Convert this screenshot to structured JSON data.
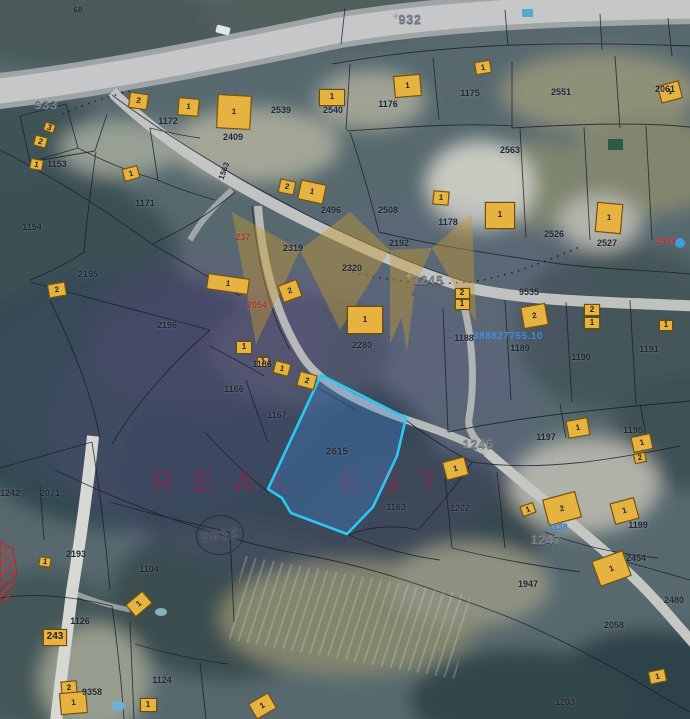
{
  "map": {
    "watermark": {
      "text": "REAL EST",
      "text_color": "rgba(150,33,68,0.40)",
      "logo_color": "#c99a2e"
    },
    "highlighted_parcel": {
      "number": "2615",
      "stroke": "#29c9f2",
      "fill": "rgba(64,140,225,0.30)",
      "label_x": 337,
      "label_y": 452
    },
    "geodetic_point": {
      "label": "5012"
    },
    "selected_object_id": {
      "text": "388827755.10",
      "color": "#3f8de8"
    },
    "road_labels": [
      [
        "932",
        410,
        19
      ],
      [
        "933",
        46,
        105
      ],
      [
        "1245",
        428,
        280
      ],
      [
        "1246",
        478,
        444
      ],
      [
        "1247",
        546,
        540
      ]
    ],
    "parcel_labels": [
      [
        "68",
        78,
        10,
        0,
        8
      ],
      [
        "1153",
        57,
        164
      ],
      [
        "1172",
        168,
        121
      ],
      [
        "2409",
        233,
        137
      ],
      [
        "2539",
        281,
        110
      ],
      [
        "2540",
        333,
        110
      ],
      [
        "1176",
        388,
        104
      ],
      [
        "1175",
        470,
        93
      ],
      [
        "2551",
        561,
        92
      ],
      [
        "2061",
        665,
        89
      ],
      [
        "1171",
        145,
        203
      ],
      [
        "1154",
        32,
        227
      ],
      [
        "1563",
        224,
        171,
        -70,
        8
      ],
      [
        "2496",
        331,
        210
      ],
      [
        "2563",
        510,
        150
      ],
      [
        "2508",
        388,
        210
      ],
      [
        "1178",
        448,
        222
      ],
      [
        "2526",
        554,
        234
      ],
      [
        "2527",
        607,
        243
      ],
      [
        "2192",
        399,
        243
      ],
      [
        "2195",
        88,
        274
      ],
      [
        "2196",
        167,
        325
      ],
      [
        "2319",
        293,
        248
      ],
      [
        "2320",
        352,
        268
      ],
      [
        "9535",
        529,
        292
      ],
      [
        "2280",
        362,
        345
      ],
      [
        "1188",
        464,
        338
      ],
      [
        "1189",
        520,
        348
      ],
      [
        "1190",
        581,
        357
      ],
      [
        "1191",
        649,
        349
      ],
      [
        "1186",
        262,
        364
      ],
      [
        "1166",
        234,
        389
      ],
      [
        "1167",
        277,
        415
      ],
      [
        "1163",
        396,
        507
      ],
      [
        "1202",
        460,
        508
      ],
      [
        "1199",
        638,
        525
      ],
      [
        "2454",
        636,
        558
      ],
      [
        "1197",
        546,
        437
      ],
      [
        "1198",
        633,
        430
      ],
      [
        "1947",
        528,
        584
      ],
      [
        "2058",
        614,
        625
      ],
      [
        "2480",
        674,
        600
      ],
      [
        "1203",
        565,
        702
      ],
      [
        "1242",
        10,
        493
      ],
      [
        "2071",
        50,
        493
      ],
      [
        "2193",
        76,
        554
      ],
      [
        "1104",
        149,
        569
      ],
      [
        "1126",
        80,
        621
      ],
      [
        "9358",
        92,
        692
      ],
      [
        "1124",
        162,
        680
      ]
    ],
    "red_labels": [
      [
        "237",
        243,
        237
      ],
      [
        "2054",
        257,
        305
      ],
      [
        "2529",
        666,
        241
      ]
    ],
    "blue_labels": [
      [
        "1138",
        558,
        527
      ]
    ],
    "buildings": [
      [
        "3",
        49,
        127,
        11,
        9,
        20
      ],
      [
        "2",
        40,
        141,
        13,
        11,
        15
      ],
      [
        "1",
        36,
        164,
        13,
        11,
        10
      ],
      [
        "2",
        138,
        101,
        19,
        16,
        8
      ],
      [
        "1",
        188,
        107,
        21,
        18,
        5
      ],
      [
        "1",
        234,
        112,
        34,
        34,
        3
      ],
      [
        "1",
        332,
        97,
        26,
        17,
        0
      ],
      [
        "1",
        131,
        173,
        16,
        13,
        -15
      ],
      [
        "2",
        287,
        187,
        16,
        14,
        12
      ],
      [
        "1",
        312,
        192,
        26,
        20,
        12
      ],
      [
        "1",
        407,
        86,
        27,
        22,
        -5
      ],
      [
        "1",
        483,
        67,
        16,
        13,
        -10
      ],
      [
        "1",
        441,
        198,
        16,
        14,
        5
      ],
      [
        "1",
        500,
        215,
        30,
        27,
        0
      ],
      [
        "1",
        609,
        218,
        26,
        30,
        5
      ],
      [
        "1",
        670,
        92,
        22,
        18,
        -15
      ],
      [
        "2",
        57,
        290,
        18,
        14,
        -10
      ],
      [
        "2",
        290,
        291,
        20,
        18,
        -20
      ],
      [
        "1",
        228,
        284,
        42,
        16,
        8
      ],
      [
        "1",
        244,
        347,
        16,
        13,
        0
      ],
      [
        "1",
        263,
        362,
        12,
        10,
        0
      ],
      [
        "1",
        282,
        368,
        16,
        13,
        15
      ],
      [
        "2",
        307,
        380,
        18,
        15,
        15
      ],
      [
        "2",
        462,
        293,
        15,
        11,
        0
      ],
      [
        "1",
        462,
        304,
        15,
        11,
        0
      ],
      [
        "2",
        534,
        316,
        25,
        22,
        -10
      ],
      [
        "2",
        592,
        310,
        16,
        12,
        0
      ],
      [
        "1",
        592,
        323,
        16,
        12,
        0
      ],
      [
        "1",
        666,
        325,
        14,
        11,
        0
      ],
      [
        "1",
        365,
        320,
        36,
        28,
        0
      ],
      [
        "1",
        578,
        428,
        22,
        18,
        -10
      ],
      [
        "1",
        642,
        443,
        20,
        16,
        -12
      ],
      [
        "2",
        640,
        458,
        12,
        10,
        -12
      ],
      [
        "1",
        455,
        468,
        23,
        19,
        -15
      ],
      [
        "1",
        528,
        509,
        14,
        11,
        -20
      ],
      [
        "2",
        562,
        508,
        34,
        27,
        -15
      ],
      [
        "1",
        624,
        511,
        25,
        22,
        -15
      ],
      [
        "1",
        611,
        568,
        33,
        27,
        -20
      ],
      [
        "1",
        657,
        676,
        17,
        13,
        -12
      ],
      [
        "1",
        45,
        562,
        12,
        10,
        10
      ],
      [
        "243",
        55,
        637,
        24,
        17,
        0
      ],
      [
        "2",
        69,
        687,
        16,
        13,
        -5
      ],
      [
        "1",
        73,
        703,
        27,
        22,
        -5
      ],
      [
        "1",
        139,
        604,
        22,
        16,
        -40
      ],
      [
        "1",
        148,
        705,
        17,
        14,
        0
      ],
      [
        "1",
        262,
        706,
        23,
        18,
        -30
      ]
    ]
  }
}
